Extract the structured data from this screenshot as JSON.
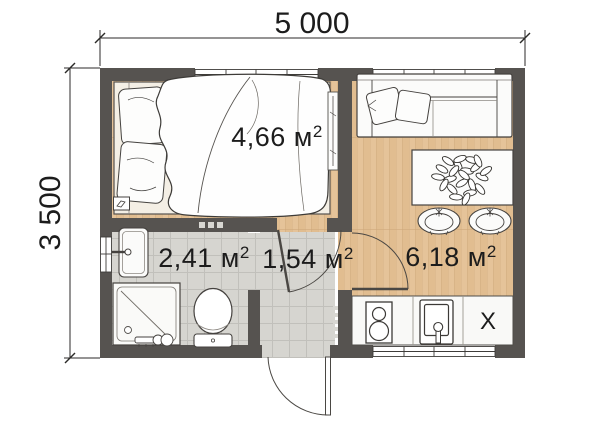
{
  "plan": {
    "dim_width": "5 000",
    "dim_height": "3 500",
    "rooms": [
      {
        "name": "bedroom",
        "label_main": "4,66 м",
        "label_sup": "2"
      },
      {
        "name": "bathroom",
        "label_main": "2,41 м",
        "label_sup": "2"
      },
      {
        "name": "hall",
        "label_main": "1,54 м",
        "label_sup": "2"
      },
      {
        "name": "living-kitchen",
        "label_main": "6,18 м",
        "label_sup": "2"
      }
    ],
    "fridge_mark": "X",
    "colors": {
      "wall": "#565350",
      "wood": "#e4c297",
      "tile": "#d4d3cf",
      "outline": "#3f3d3a",
      "background": "#ffffff",
      "dimension_text": "#1c1c1c"
    }
  }
}
